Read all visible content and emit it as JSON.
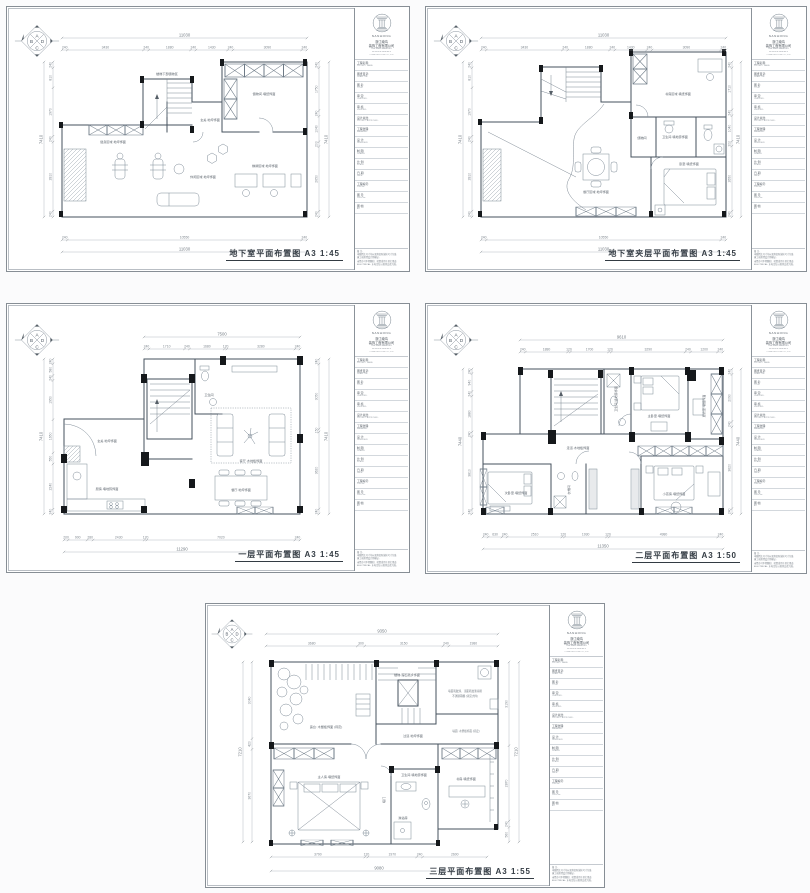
{
  "page": {
    "background": "#fbfbfc",
    "sheet_background": "#ffffff",
    "line_color": "#46525e",
    "column_fill": "#15181b"
  },
  "compass": {
    "top": "A",
    "left": "B",
    "bottom": "C",
    "right": "D"
  },
  "company": {
    "logo": "NANHONG",
    "lines": [
      "浙江南鸿",
      "装饰工程有限公司",
      "ZHE JIANG NANHONG",
      "INTERIOR DESIGN &",
      "CONSTRUCTION CO., LTD"
    ]
  },
  "titleblock": {
    "fields": [
      {
        "zh": "工程名称:",
        "en": "PROJECT NAME:"
      },
      {
        "zh": "图纸目录:",
        "en": "DRAW. TBL:"
      },
      {
        "zh": "图  名:",
        "en": "TITLE:"
      },
      {
        "zh": "审  定:",
        "en": "CHECKED:"
      },
      {
        "zh": "审  核:",
        "en": "VERIFIED:"
      },
      {
        "zh": "设计总监:",
        "en": "PROJECT APPROVED:"
      },
      {
        "zh": "工程监理:",
        "en": "MANAGER:"
      },
      {
        "zh": "设  计:",
        "en": "DESIGNER:"
      },
      {
        "zh": "制  图:",
        "en": "DRAWN:"
      },
      {
        "zh": "比  例:",
        "en": "SCALE:"
      },
      {
        "zh": "日  期:",
        "en": "DATE:"
      },
      {
        "zh": "工程编号:",
        "en": "JOB No.:"
      },
      {
        "zh": "图  号:",
        "en": "DWG No.:"
      },
      {
        "zh": "图  幅:",
        "en": "A3"
      }
    ],
    "notes": [
      "备 注:",
      "本图所注尺寸均以现场实际放样尺寸为准,",
      "施工前须经设计师确认;",
      "未经许可不得翻印、转借或用于其它用途;",
      "ELECTRICAL: 水电定位以现场交底为准。"
    ]
  },
  "sheets": [
    {
      "id": "basement",
      "title": "地下室平面布置图 A3 1:45",
      "dims": {
        "top_total": "11030",
        "top": [
          "240",
          "3430",
          "240",
          "1880",
          "240",
          "1430",
          "240",
          "3090",
          "240"
        ],
        "bottom_total": "11030",
        "bottom": [
          "240",
          "10550",
          "240"
        ],
        "left_total": "7410",
        "left": [
          "240",
          "810",
          "1970",
          "240",
          "2810",
          "240"
        ],
        "right_total": "7410",
        "right": [
          "240",
          "1750",
          "240",
          "1040",
          "200",
          "2650",
          "240"
        ]
      },
      "labels": [
        "楼梯下部储物区",
        "健身区域·地坪饰面",
        "休闲区域·地坪饰面",
        "棋牌区域·地坪饰面",
        "储物间·墙纸饰面",
        "玄关·地坪饰面"
      ]
    },
    {
      "id": "basement-mezzanine",
      "title": "地下室夹层平面布置图 A3 1:45",
      "dims": {
        "top_total": "11030",
        "top": [
          "240",
          "3430",
          "240",
          "1880",
          "240",
          "1430",
          "240",
          "3090",
          "240"
        ],
        "bottom_total": "11030",
        "bottom": [
          "240",
          "10550",
          "240"
        ],
        "left_total": "7410",
        "left": [
          "240",
          "810",
          "1970",
          "240",
          "2810",
          "240"
        ],
        "right_total": "7410",
        "right": [
          "240",
          "1710",
          "240",
          "1040",
          "200",
          "2650",
          "240"
        ]
      },
      "labels": [
        "书房区域·墙纸饰面",
        "卫生间·墙地砖饰面",
        "储物间",
        "餐厅区域·地坪饰面",
        "卧室·墙纸饰面"
      ]
    },
    {
      "id": "first-floor",
      "title": "一层平面布置图 A3 1:45",
      "dims": {
        "top_total": "7500",
        "top": [
          "240",
          "1710",
          "240",
          "1680",
          "120",
          "3280",
          "240"
        ],
        "bottom_total": "11290",
        "bottom": [
          "200",
          "900",
          "280",
          "2430",
          "120",
          "7020",
          "240"
        ],
        "left_total": "7410",
        "left": [
          "240",
          "580",
          "240",
          "1950",
          "1650",
          "550",
          "2240",
          "240"
        ],
        "right_total": "7410",
        "right": [
          "240",
          "3050",
          "150",
          "3620",
          "240"
        ]
      },
      "labels": [
        "客厅·木地板饰面",
        "餐厅·地坪饰面",
        "厨房·墙地砖饰面",
        "卫生间",
        "玄关·地坪饰面"
      ]
    },
    {
      "id": "second-floor",
      "title": "二层平面布置图 A3 1:50",
      "dims": {
        "top_total": "9610",
        "top": [
          "240",
          "1880",
          "120",
          "1700",
          "120",
          "3290",
          "240",
          "1200",
          "240"
        ],
        "bottom_total": "11350",
        "bottom": [
          "240",
          "630",
          "240",
          "2510",
          "120",
          "1930",
          "120",
          "4980",
          "240"
        ],
        "left_total": "7440",
        "left": [
          "240",
          "940",
          "240",
          "1880",
          "240",
          "3810",
          "240"
        ],
        "right_total": "7440",
        "right": [
          "240",
          "2090",
          "240",
          "3620",
          "240"
        ]
      },
      "labels": [
        "主卧室·墙纸饰面",
        "更衣室·墙纸饰面",
        "卫生间·墙地砖饰面",
        "次卧室·墙纸饰面",
        "衣帽间",
        "小孩房·墙纸饰面",
        "走道·木地板饰面"
      ]
    },
    {
      "id": "third-floor",
      "title": "三层平面布置图 A3 1:55",
      "dims": {
        "top_total": "9350",
        "top": [
          "3680",
          "300",
          "3150",
          "240",
          "1980"
        ],
        "bottom_total": "9080",
        "bottom": [
          "3790",
          "120",
          "1970",
          "240",
          "2600"
        ],
        "left_total": "7210",
        "left": [
          "3040",
          "420",
          "3670"
        ],
        "right_total": "7210",
        "right": [
          "3190",
          "2870",
          "240",
          "560"
        ]
      },
      "labels": [
        "露台: 木塑板饰面 (待定)",
        "楼梯·理石踏步饰面",
        "过道·地坪饰面",
        "主人房·墙纸饰面",
        "卫生间·墙地砖饰面",
        "书房·墙纸饰面",
        "淋浴房",
        "暗门",
        "墙面乳胶漆、顶面乳胶漆涂刷",
        "不锈钢雨棚 (详见大样)",
        "墙面: 木塑板饰面 (待定)"
      ]
    }
  ]
}
